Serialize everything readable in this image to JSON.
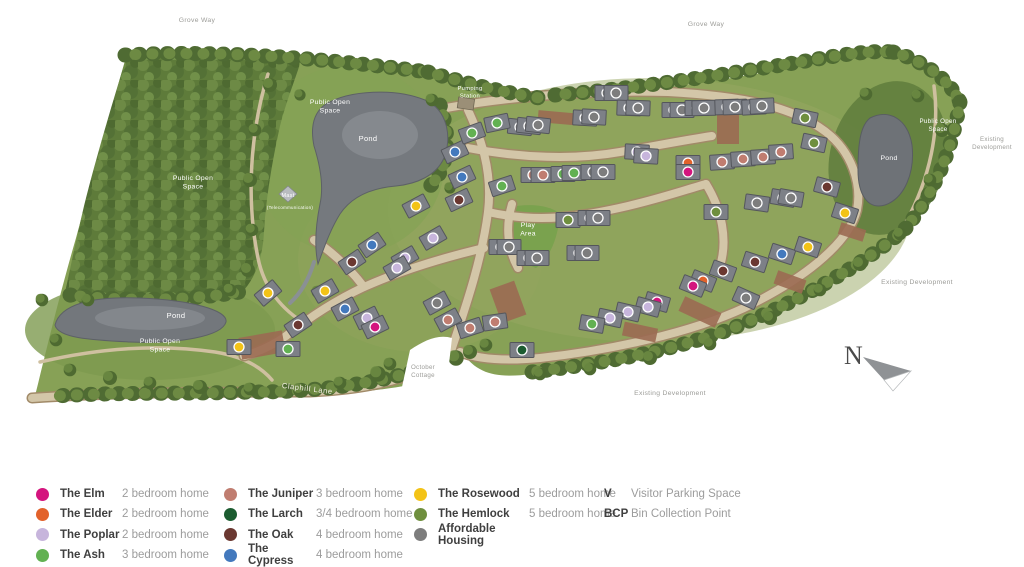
{
  "colors": {
    "elm": "#d4157e",
    "elder": "#e2622b",
    "poplar": "#c7b5dc",
    "ash": "#62b152",
    "juniper": "#c07d70",
    "larch": "#1c5c30",
    "oak": "#6b3831",
    "cypress": "#4379bd",
    "rosewood": "#f3c317",
    "hemlock": "#6f8f3e",
    "affordable": "#7d7d7d"
  },
  "compass": {
    "letter": "N"
  },
  "map": {
    "labels": [
      {
        "text": "Grove Way",
        "x": 197,
        "y": 22,
        "cls": "grey",
        "size": 6.8
      },
      {
        "text": "Grove Way",
        "x": 706,
        "y": 26,
        "cls": "grey",
        "size": 6.8
      },
      {
        "text": "Public Open\nSpace",
        "x": 330,
        "y": 104,
        "cls": "white",
        "size": 6.8
      },
      {
        "text": "Pond",
        "x": 368,
        "y": 141,
        "cls": "white",
        "size": 7.5
      },
      {
        "text": "Pumping\nStation",
        "x": 470,
        "y": 90,
        "cls": "white",
        "size": 5.8
      },
      {
        "text": "Public Open\nSpace",
        "x": 193,
        "y": 180,
        "cls": "white",
        "size": 6.8
      },
      {
        "text": "Mast",
        "x": 288,
        "y": 197,
        "cls": "white",
        "size": 5.5
      },
      {
        "text": "(Telecommunication)",
        "x": 290,
        "y": 209,
        "cls": "white",
        "size": 4.4
      },
      {
        "text": "Play\nArea",
        "x": 528,
        "y": 227,
        "cls": "white",
        "size": 6.8
      },
      {
        "text": "Pond",
        "x": 176,
        "y": 318,
        "cls": "white",
        "size": 7.5
      },
      {
        "text": "Public Open\nSpace",
        "x": 160,
        "y": 343,
        "cls": "white",
        "size": 6.8
      },
      {
        "text": "Public Open\nSpace",
        "x": 938,
        "y": 123,
        "cls": "white",
        "size": 6.2
      },
      {
        "text": "Pond",
        "x": 889,
        "y": 160,
        "cls": "white",
        "size": 6.8
      },
      {
        "text": "Claphill Lane",
        "x": 307,
        "y": 391,
        "cls": "road",
        "size": 7.5,
        "rot": 7
      },
      {
        "text": "October\nCottage",
        "x": 423,
        "y": 369,
        "cls": "grey",
        "size": 6.2
      },
      {
        "text": "Existing Development",
        "x": 670,
        "y": 395,
        "cls": "grey",
        "size": 6.8
      },
      {
        "text": "Existing\nDevelopment",
        "x": 992,
        "y": 141,
        "cls": "grey",
        "size": 6.2
      },
      {
        "text": "Existing Development",
        "x": 917,
        "y": 284,
        "cls": "grey",
        "size": 6.8
      }
    ],
    "plots": [
      [
        520,
        127,
        "affordable",
        6
      ],
      [
        529,
        126,
        "affordable",
        6
      ],
      [
        538,
        125,
        "affordable",
        6
      ],
      [
        585,
        118,
        "affordable",
        3
      ],
      [
        594,
        117,
        "affordable",
        3
      ],
      [
        607,
        93,
        "affordable",
        0
      ],
      [
        616,
        93,
        "affordable",
        0
      ],
      [
        629,
        108,
        "affordable",
        2
      ],
      [
        638,
        108,
        "affordable",
        2
      ],
      [
        674,
        110,
        "affordable",
        0
      ],
      [
        682,
        110,
        "affordable",
        0
      ],
      [
        697,
        108,
        "affordable",
        0
      ],
      [
        704,
        108,
        "affordable",
        -1
      ],
      [
        727,
        107,
        "affordable",
        -2
      ],
      [
        735,
        107,
        "affordable",
        -2
      ],
      [
        754,
        107,
        "affordable",
        -3
      ],
      [
        762,
        106,
        "affordable",
        -3
      ],
      [
        455,
        152,
        "cypress",
        -25
      ],
      [
        472,
        133,
        "ash",
        -20
      ],
      [
        497,
        123,
        "ash",
        -12
      ],
      [
        462,
        177,
        "cypress",
        -25
      ],
      [
        502,
        186,
        "ash",
        -18
      ],
      [
        533,
        175,
        "juniper",
        0
      ],
      [
        543,
        175,
        "juniper",
        0
      ],
      [
        563,
        174,
        "ash",
        0
      ],
      [
        574,
        173,
        "ash",
        0
      ],
      [
        593,
        172,
        "affordable",
        0
      ],
      [
        603,
        172,
        "affordable",
        0
      ],
      [
        637,
        152,
        "poplar",
        3
      ],
      [
        646,
        156,
        "poplar",
        3
      ],
      [
        688,
        163,
        "elder",
        0
      ],
      [
        688,
        172,
        "elm",
        0
      ],
      [
        722,
        162,
        "juniper",
        -4
      ],
      [
        743,
        159,
        "juniper",
        -4
      ],
      [
        763,
        157,
        "juniper",
        -4
      ],
      [
        781,
        152,
        "juniper",
        -4
      ],
      [
        805,
        118,
        "hemlock",
        12
      ],
      [
        814,
        143,
        "hemlock",
        12
      ],
      [
        827,
        187,
        "oak",
        15
      ],
      [
        783,
        198,
        "affordable",
        10
      ],
      [
        791,
        198,
        "affordable",
        10
      ],
      [
        757,
        203,
        "affordable",
        8
      ],
      [
        845,
        213,
        "rosewood",
        18
      ],
      [
        716,
        212,
        "hemlock",
        0
      ],
      [
        568,
        220,
        "hemlock",
        0
      ],
      [
        590,
        218,
        "affordable",
        0
      ],
      [
        598,
        218,
        "affordable",
        0
      ],
      [
        501,
        247,
        "affordable",
        0
      ],
      [
        509,
        247,
        "affordable",
        0
      ],
      [
        529,
        258,
        "affordable",
        0
      ],
      [
        537,
        258,
        "affordable",
        0
      ],
      [
        579,
        253,
        "affordable",
        0
      ],
      [
        587,
        253,
        "affordable",
        0
      ],
      [
        723,
        271,
        "oak",
        20
      ],
      [
        755,
        262,
        "oak",
        18
      ],
      [
        782,
        254,
        "cypress",
        18
      ],
      [
        808,
        247,
        "rosewood",
        18
      ],
      [
        746,
        298,
        "affordable",
        24
      ],
      [
        703,
        281,
        "elder",
        22
      ],
      [
        693,
        286,
        "elm",
        22
      ],
      [
        657,
        302,
        "elm",
        16
      ],
      [
        648,
        307,
        "poplar",
        15
      ],
      [
        628,
        312,
        "poplar",
        13
      ],
      [
        610,
        318,
        "poplar",
        12
      ],
      [
        592,
        324,
        "ash",
        10
      ],
      [
        437,
        303,
        "affordable",
        -28
      ],
      [
        448,
        320,
        "juniper",
        -28
      ],
      [
        470,
        328,
        "juniper",
        -18
      ],
      [
        495,
        322,
        "juniper",
        -8
      ],
      [
        522,
        350,
        "larch",
        0
      ],
      [
        459,
        200,
        "oak",
        -25
      ],
      [
        416,
        206,
        "rosewood",
        -28
      ],
      [
        433,
        238,
        "poplar",
        -30
      ],
      [
        405,
        258,
        "poplar",
        -30
      ],
      [
        397,
        268,
        "poplar",
        -30
      ],
      [
        372,
        245,
        "cypress",
        -34
      ],
      [
        352,
        262,
        "oak",
        -34
      ],
      [
        325,
        291,
        "rosewood",
        -30
      ],
      [
        268,
        293,
        "rosewood",
        -40
      ],
      [
        345,
        309,
        "cypress",
        -28
      ],
      [
        367,
        318,
        "poplar",
        -26
      ],
      [
        375,
        327,
        "elm",
        -26
      ],
      [
        298,
        325,
        "oak",
        -34
      ],
      [
        239,
        347,
        "rosewood",
        0
      ],
      [
        288,
        349,
        "ash",
        0
      ]
    ]
  },
  "legend": {
    "columns": [
      [
        {
          "name": "The Elm",
          "desc": "2 bedroom home",
          "color": "elm"
        },
        {
          "name": "The Elder",
          "desc": "2 bedroom home",
          "color": "elder"
        },
        {
          "name": "The Poplar",
          "desc": "2 bedroom home",
          "color": "poplar"
        },
        {
          "name": "The Ash",
          "desc": "3 bedroom home",
          "color": "ash"
        }
      ],
      [
        {
          "name": "The Juniper",
          "desc": "3 bedroom home",
          "color": "juniper"
        },
        {
          "name": "The Larch",
          "desc": "3/4 bedroom home",
          "color": "larch"
        },
        {
          "name": "The Oak",
          "desc": "4 bedroom home",
          "color": "oak"
        },
        {
          "name": "The Cypress",
          "desc": "4 bedroom home",
          "color": "cypress"
        }
      ],
      [
        {
          "name": "The Rosewood",
          "desc": "5 bedroom home",
          "color": "rosewood"
        },
        {
          "name": "The Hemlock",
          "desc": "5 bedroom home",
          "color": "hemlock"
        },
        {
          "name": "Affordable Housing",
          "desc": "",
          "color": "affordable"
        }
      ]
    ],
    "notes": [
      {
        "symbol": "V",
        "desc": "Visitor Parking Space"
      },
      {
        "symbol": "BCP",
        "desc": "Bin Collection Point"
      }
    ]
  }
}
